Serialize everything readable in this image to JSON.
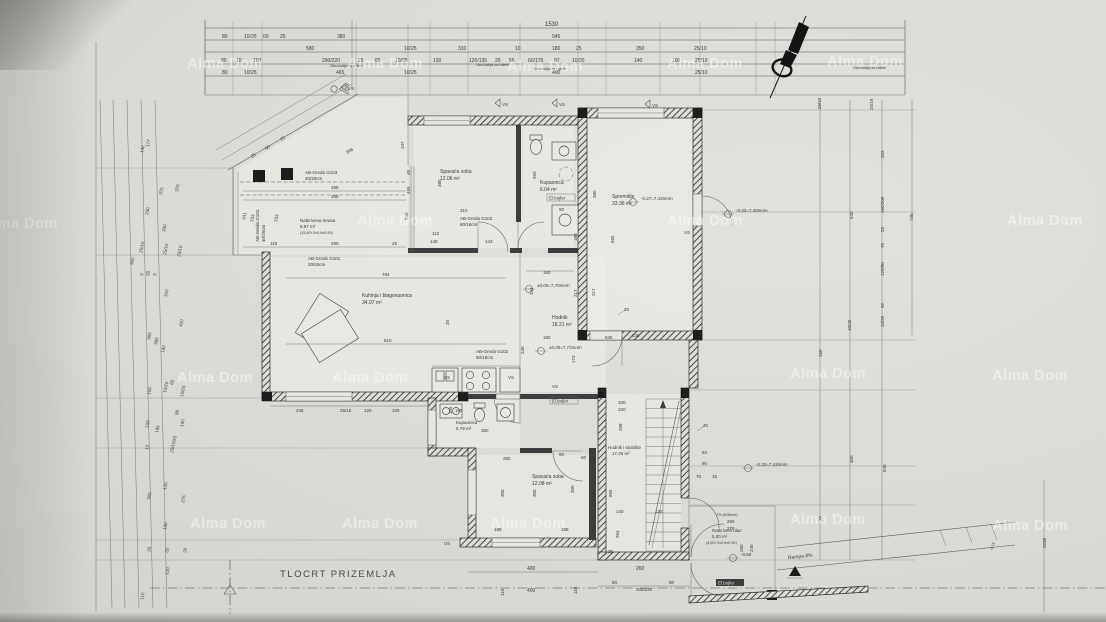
{
  "title": {
    "label": "TLOCRT PRIZEMLJA"
  },
  "watermark": {
    "text": "Alma Dom"
  },
  "rooms": [
    {
      "name": "Natkrivena terasa",
      "area": "8.97 m²",
      "note": "(15,82+2x0,9x0,90)"
    },
    {
      "name": "Spavaća soba",
      "area": "12.06 m²"
    },
    {
      "name": "Kupaonica",
      "area": "6.04 m²"
    },
    {
      "name": "Spremište",
      "area": "33.36 m²"
    },
    {
      "name": "Kuhinja i blagovaonica",
      "area": "34.07 m²"
    },
    {
      "name": "Hodnik",
      "area": "18.21 m²"
    },
    {
      "name": "Kupaonica",
      "area": "5.79 m²"
    },
    {
      "name": "Spavaća soba",
      "area": "12.08 m²"
    },
    {
      "name": "Hodnik i stubište",
      "area": "17.26 m²"
    },
    {
      "name": "Natkriveni ulaz",
      "area": "5,00 m²",
      "note": "(4,50+2x0,9x0,90)"
    }
  ],
  "beams": [
    {
      "name": "AB-Greda G103",
      "size": "40/20cm"
    },
    {
      "name": "AB-Greda G104",
      "size": "40/20cm"
    },
    {
      "name": "AB-Grede G101",
      "size": "20/20cm"
    },
    {
      "name": "AB-Greda G102",
      "size": "80/18cm"
    },
    {
      "name": "AB-Greda G102",
      "size": "80/18cm"
    }
  ],
  "levels": [
    "±0,00=7,70mnm",
    "±0,00=7,72mnm",
    "-0,27=7,43mnm",
    "-0,32=7,40mnm",
    "-0,32=7,43mnm",
    "-0,60"
  ],
  "marks": {
    "vs": "VS",
    "z1": "Z1",
    "boiler": "El.bojler",
    "ramp": "Rampa 8%",
    "slope": "7% (5/30cm)",
    "shutter": "Okn-kutija za rolete",
    "ramp_level": "-0,15"
  },
  "dims": {
    "total": [
      "1530"
    ],
    "top_b": [
      "80",
      "10/25",
      "60",
      "25",
      "380",
      "945"
    ],
    "top_c": [
      "580",
      "10/25",
      "310",
      "10",
      "180",
      "25",
      "350",
      "25/10"
    ],
    "top_d": [
      "80",
      "10",
      "110",
      "290/220",
      "25",
      "65",
      "10/25",
      "130",
      "120/135",
      "25",
      "56",
      "60/170",
      "97",
      "10/25",
      "140",
      "100",
      "25/10"
    ],
    "top_e": [
      "80",
      "10/25",
      "465",
      "10/25",
      "490",
      "25/10"
    ],
    "left": [
      "142",
      "177",
      "375",
      "375",
      "230",
      "330",
      "900",
      "25/10",
      "25/10",
      "25/10",
      "5",
      "65",
      "5",
      "310",
      "420",
      "360",
      "385",
      "160",
      "150",
      "10/25",
      "60",
      "10/25",
      "150",
      "185",
      "160",
      "80",
      "10",
      "25/10/25",
      "120",
      "300",
      "275",
      "130",
      "20",
      "20",
      "20",
      "120",
      "110"
    ],
    "right": [
      "25/10",
      "25/10",
      "253",
      "645",
      "100/200",
      "735",
      "25",
      "75",
      "120/90",
      "92",
      "10/25",
      "10/25",
      "160",
      "460",
      "840",
      "26",
      "2638"
    ],
    "bottom": [
      "245",
      "25/10",
      "120",
      "100",
      "165",
      "400",
      "400",
      "110",
      "110",
      "260",
      "80",
      "100/220",
      "80",
      "250",
      "270",
      "260",
      "240"
    ],
    "stairs": [
      "100",
      "220",
      "268",
      "665",
      "140",
      "120",
      "264",
      "83",
      "90",
      "70",
      "15"
    ],
    "bedroom1": [
      "310",
      "112",
      "140",
      "143",
      "380",
      "260"
    ],
    "bath1": [
      "90",
      "180"
    ],
    "hall": [
      "180",
      "144",
      "217",
      "217",
      "180",
      "240",
      "173",
      "535"
    ],
    "kitchen": [
      "784",
      "810",
      "20"
    ],
    "storage": [
      "380",
      "665",
      "335"
    ],
    "terrace": [
      "368",
      "468",
      "468",
      "25",
      "60",
      "25",
      "233",
      "233",
      "241",
      "137",
      "40",
      "455",
      "233",
      "116",
      "290",
      "25"
    ],
    "bedroom2": [
      "250",
      "90",
      "60",
      "300",
      "300",
      "300",
      "188",
      "188"
    ],
    "bath2": [
      "350",
      "165"
    ]
  }
}
